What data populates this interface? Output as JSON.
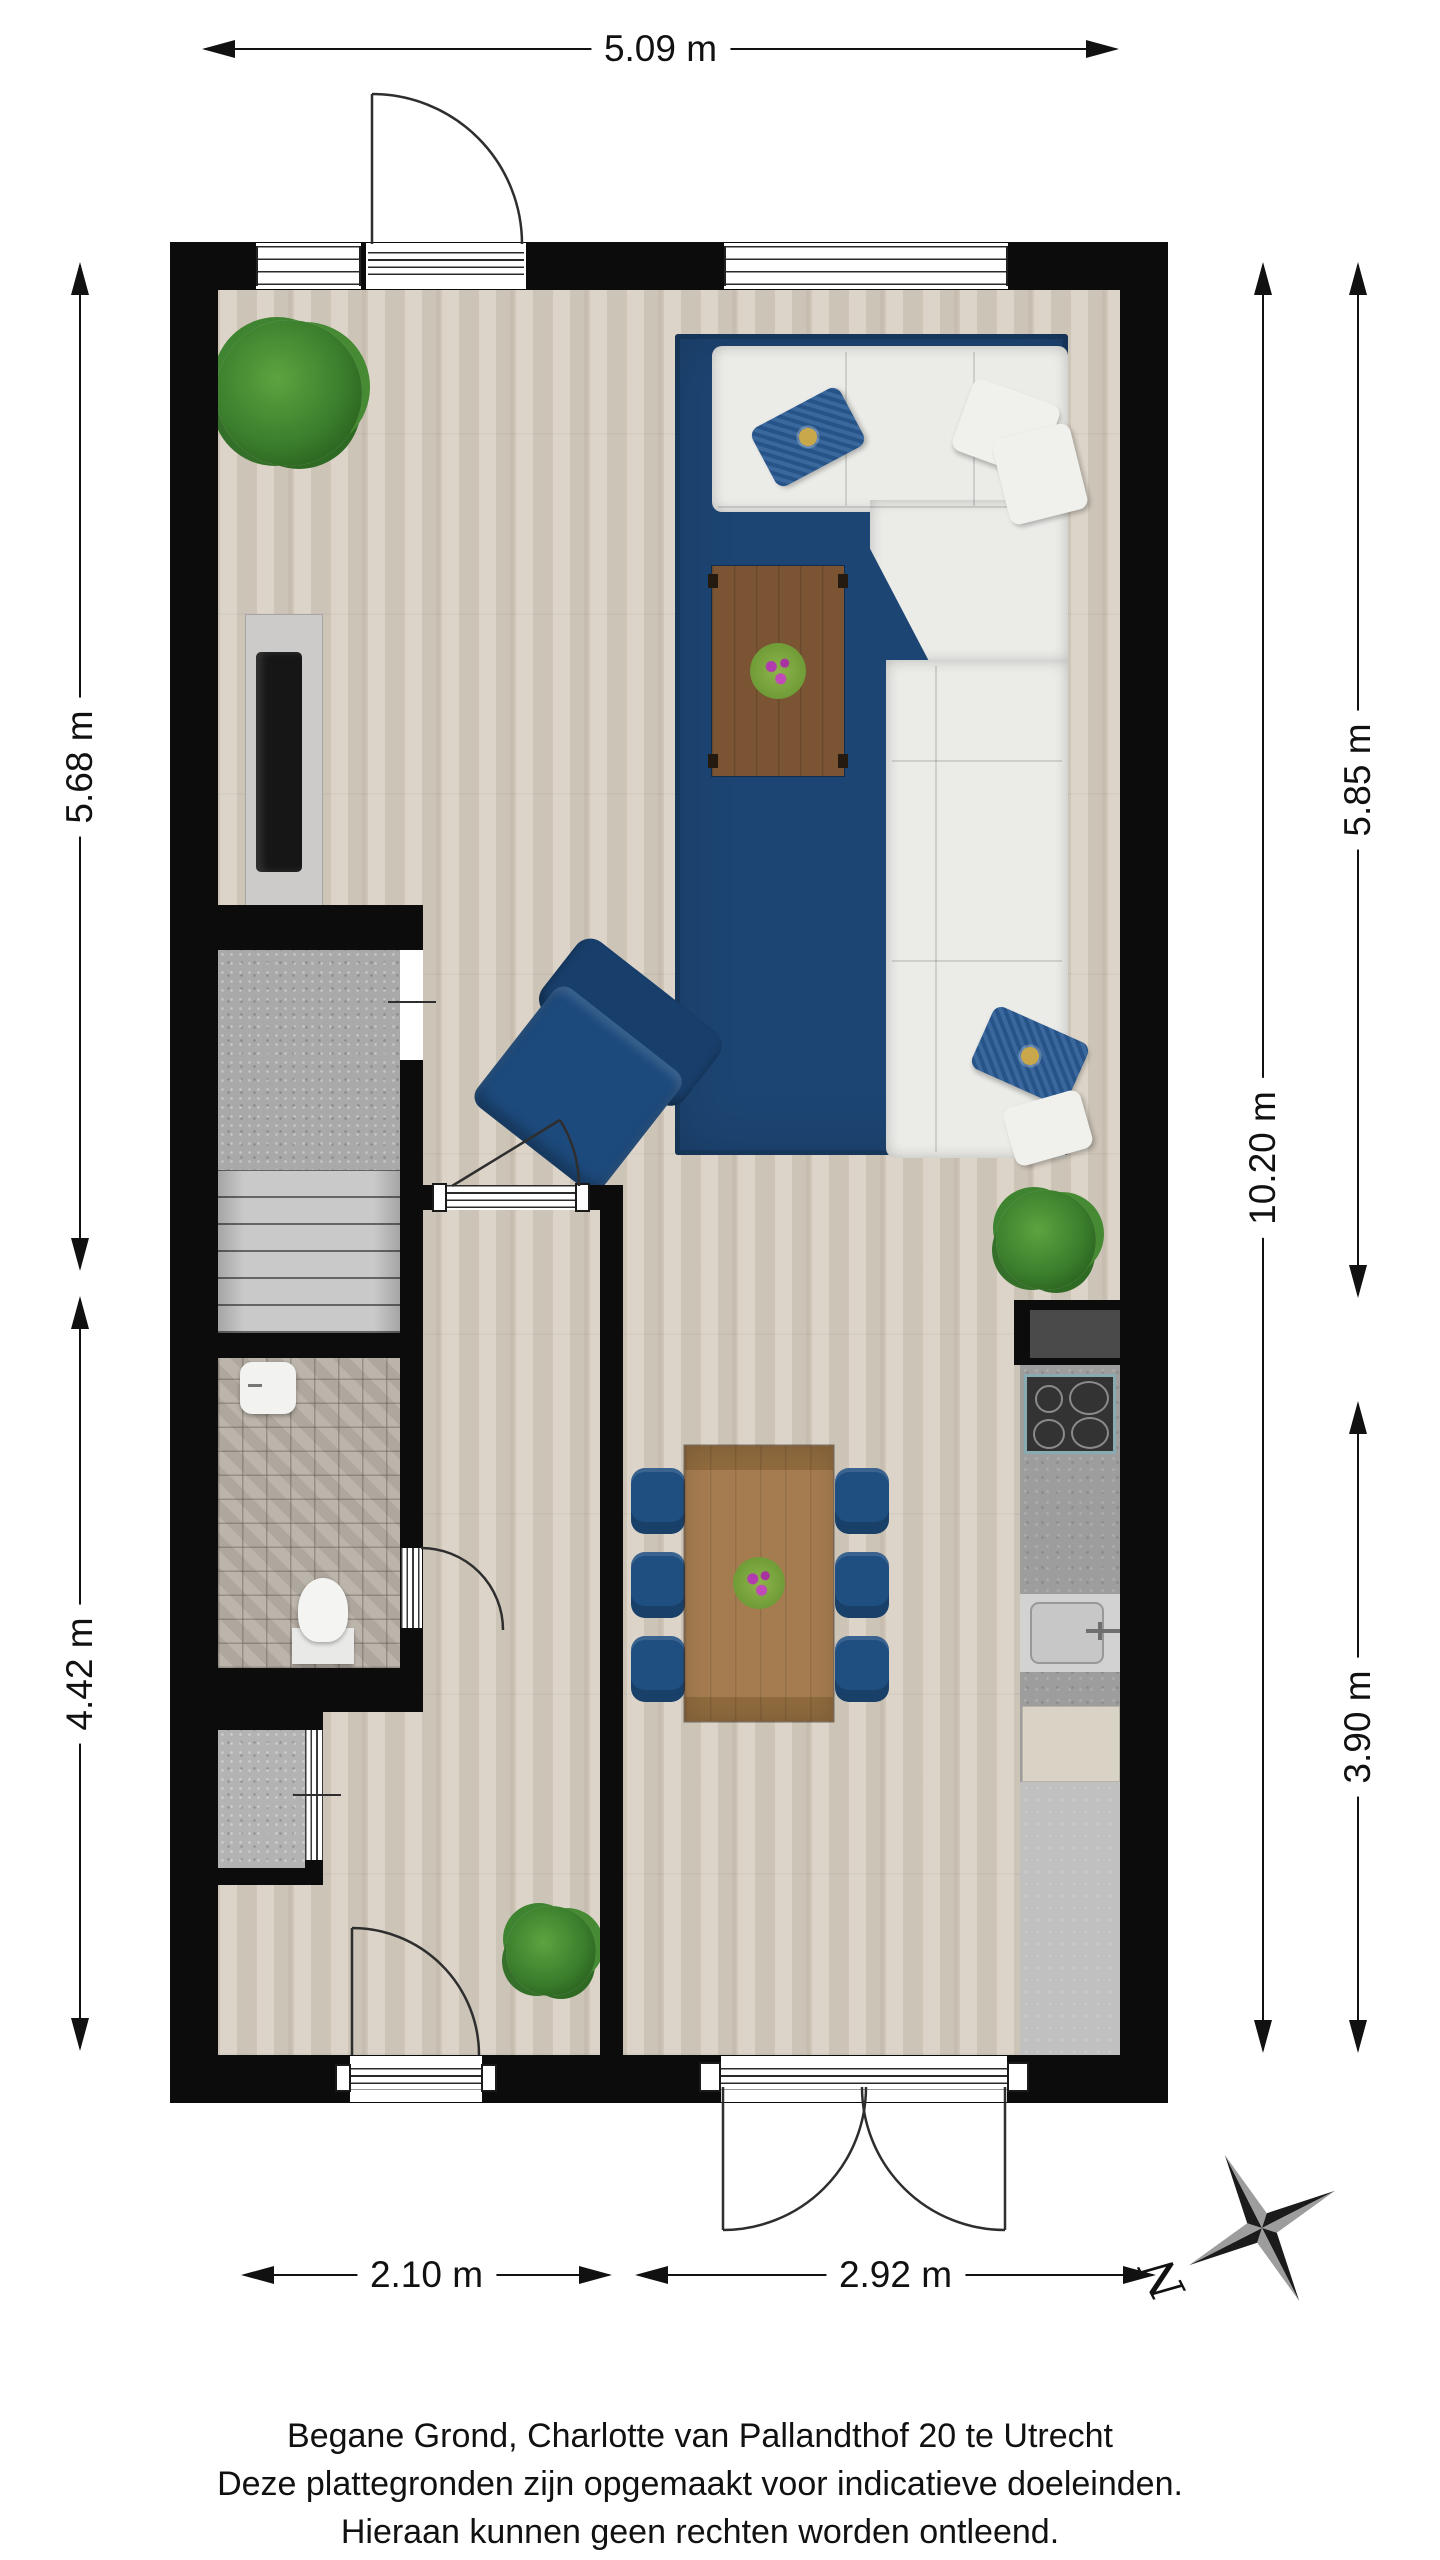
{
  "plan": {
    "type": "floorplan",
    "caption": {
      "line1": "Begane Grond, Charlotte van Pallandthof 20 te Utrecht",
      "line2": "Deze plattegronden zijn opgemaakt voor indicatieve doeleinden.",
      "line3": "Hieraan kunnen geen rechten worden ontleend."
    },
    "dimensions": {
      "top": "5.09 m",
      "left_upper": "5.68 m",
      "left_lower": "4.42 m",
      "right_total": "10.20 m",
      "right_upper": "5.85 m",
      "right_lower": "3.90 m",
      "bottom_left": "2.10 m",
      "bottom_right": "2.92 m"
    },
    "compass": {
      "north": "N"
    },
    "colors": {
      "wall_black": "#0c0c0c",
      "wood_floor": "#d8cfc2",
      "rug_navy": "#1d4573",
      "sofa_white": "#ebebe8",
      "chair_blue": "#1f4f80",
      "coffee_table_brown": "#7b5533",
      "dining_table_brown": "#a57c50",
      "kitchen_counter_gray": "#9d9d9d",
      "toilet_tile_gray": "#b7b0a6",
      "plant_green": "#3a7d2c"
    }
  }
}
